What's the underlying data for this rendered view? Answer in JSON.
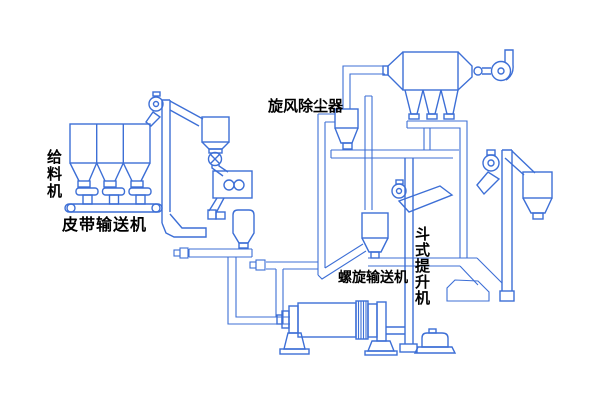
{
  "diagram": {
    "background_color": "#ffffff",
    "line_color": "#3d6fd6",
    "label_color": "#000000",
    "labels": {
      "feeder": "给料机",
      "belt_conveyor": "皮带输送机",
      "cyclone_dust_collector": "旋风除尘器",
      "screw_conveyor": "螺旋输送机",
      "bucket_elevator": "斗式提升机"
    },
    "components": [
      "feed-hoppers",
      "vibrating-feeders",
      "belt-conveyor",
      "bucket-elevator-left",
      "screen-hopper",
      "rotary-valve",
      "roller-mill",
      "surge-hopper",
      "tee-pipe",
      "small-cyclone",
      "cyclone-riser-pipe",
      "bag-filter",
      "exhaust-fan",
      "duct-shelf",
      "rotary-drum",
      "drum-pedestals",
      "discharge-cyclone",
      "screw-conveyor-pipe",
      "bucket-elevator-center",
      "drive-motor",
      "bucket-elevator-right",
      "product-cyclone"
    ]
  }
}
